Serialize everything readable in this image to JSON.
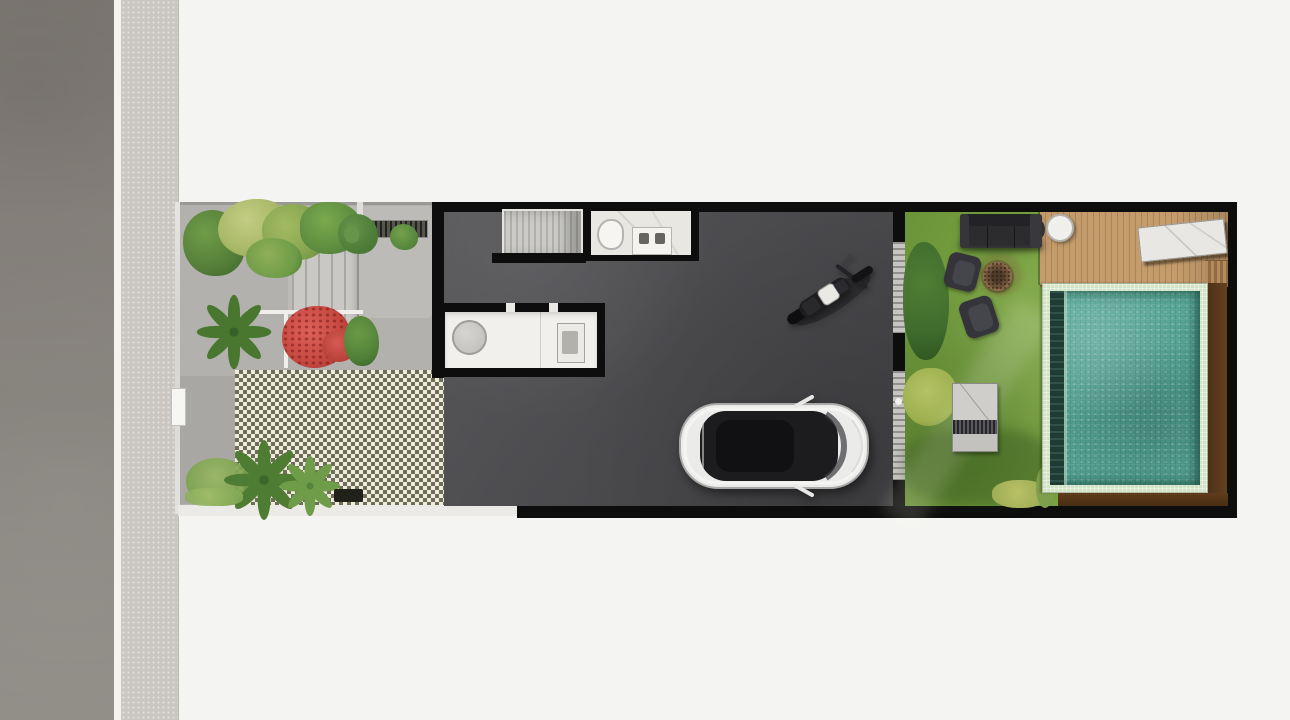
{
  "colors": {
    "bg": "#f4f4f2",
    "road": "#8a857f",
    "curb": "#f4f3f0",
    "sidewalk": "#cac7c2",
    "paving": "#b2b1ad",
    "paving_light": "#bfbeba",
    "checker_dark": "#6e6e58",
    "checker_light": "#edebdc",
    "threshold": "#90918a",
    "wall": "#0d0d0d",
    "marble": "#e9e7e2",
    "counter": "#f1f0ed",
    "glass_door": "#c6c5c2",
    "door_rung": "#8f8e8b",
    "lawn": "#7aa243",
    "deck": "#c49c6c",
    "deck_line": "#ab8459",
    "pool_tile": "#d2e3c6",
    "pool_water": "#57a292",
    "pool_ledge": "#203b34",
    "wood": "#5a3a1f",
    "sofa": "#2c2c2f",
    "daybed": "#c8c7c3",
    "red_shrub": "#c74a42",
    "foliage_dark": "#3f7030",
    "foliage_light": "#a9b868",
    "car_body": "#ebebea",
    "car_glass": "#1c1c1f",
    "moto_body": "#1d1d20",
    "moto_tank": "#eae9e5"
  },
  "areas": {
    "street": {
      "label": "asphalt road along left edge"
    },
    "sidewalk": {
      "label": "paver sidewalk strip"
    },
    "front_garden": {
      "label": "front garden with concrete paving, entry steps, planters and grass-block driveway"
    },
    "house": {
      "label": "house ground floor with staircase, bathroom, kitchen counter and garage hall"
    },
    "backyard": {
      "label": "backyard with lawn, lounge furniture, fire pit, timber deck and swimming pool"
    }
  },
  "objects": {
    "car": {
      "label": "white car parked in garage, top view"
    },
    "motorcycle": {
      "label": "black motorcycle with light fuel tank parked diagonally"
    },
    "staircase": {
      "label": "staircase treads"
    },
    "toilet": {
      "label": "toilet"
    },
    "vanity": {
      "label": "bathroom vanity with twin basins"
    },
    "kitchen_counter": {
      "label": "white kitchen counter with round table and sink"
    },
    "sliding_door": {
      "label": "glass sliding door between garage hall and backyard"
    },
    "sofa": {
      "label": "charcoal outdoor sofa"
    },
    "armchair_upper": {
      "label": "dark outdoor armchair"
    },
    "armchair_lower": {
      "label": "dark outdoor armchair"
    },
    "fire_pit": {
      "label": "round fire pit on lawn"
    },
    "daybed": {
      "label": "grey bench with striped cushion"
    },
    "round_table": {
      "label": "white round table on deck"
    },
    "stone_lounger": {
      "label": "white stone slab lounger on deck"
    },
    "pool": {
      "label": "mosaic-tiled swimming pool with dark bench ledge"
    },
    "deck_steps": {
      "label": "timber steps at deck corner"
    },
    "red_shrub": {
      "label": "red flowering shrub in planter"
    },
    "palm": {
      "label": "palm plant"
    },
    "grate": {
      "label": "drainage grate strip"
    },
    "entry_steps": {
      "label": "entry steps in front garden"
    }
  }
}
